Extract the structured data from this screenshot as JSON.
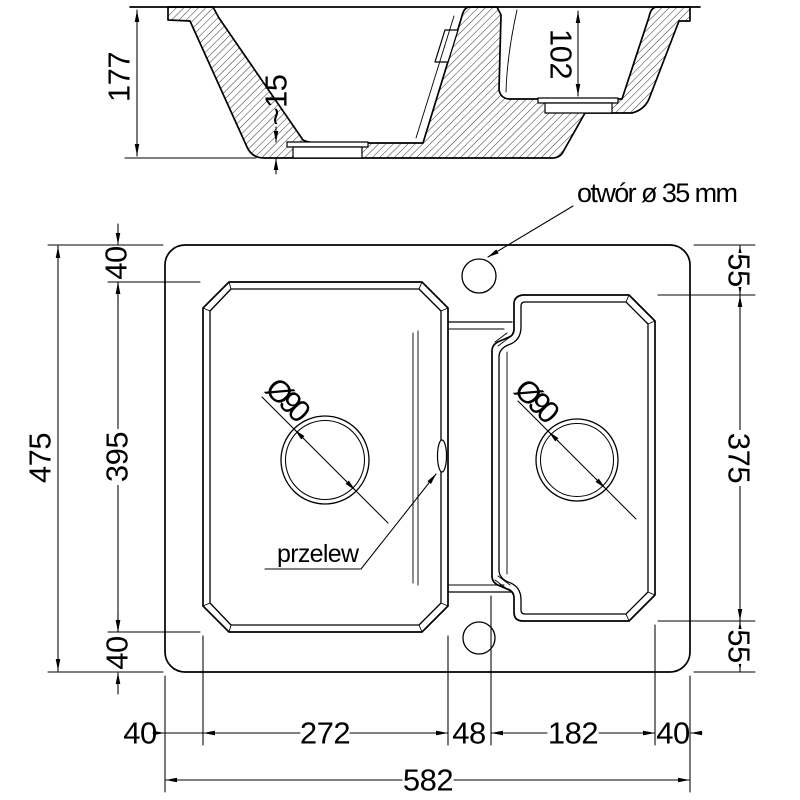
{
  "section_view": {
    "depth_main_mm": "177",
    "recess_depth_mm": "~15",
    "depth_small_mm": "102"
  },
  "plan_view": {
    "tap_hole_label": "otwór ø 35 mm",
    "overflow_label": "przelew",
    "drain_left_label": "Ø90",
    "drain_right_label": "Ø90",
    "dims_left": {
      "top_margin": "40",
      "bowl_height": "395",
      "bottom_margin": "40",
      "overall_height": "475"
    },
    "dims_right": {
      "top_margin": "55",
      "bowl_height": "375",
      "bottom_margin": "55"
    },
    "dims_bottom": {
      "left_margin": "40",
      "left_bowl_width": "272",
      "divider_width": "48",
      "right_bowl_width": "182",
      "right_margin": "40",
      "overall_width": "582"
    }
  }
}
